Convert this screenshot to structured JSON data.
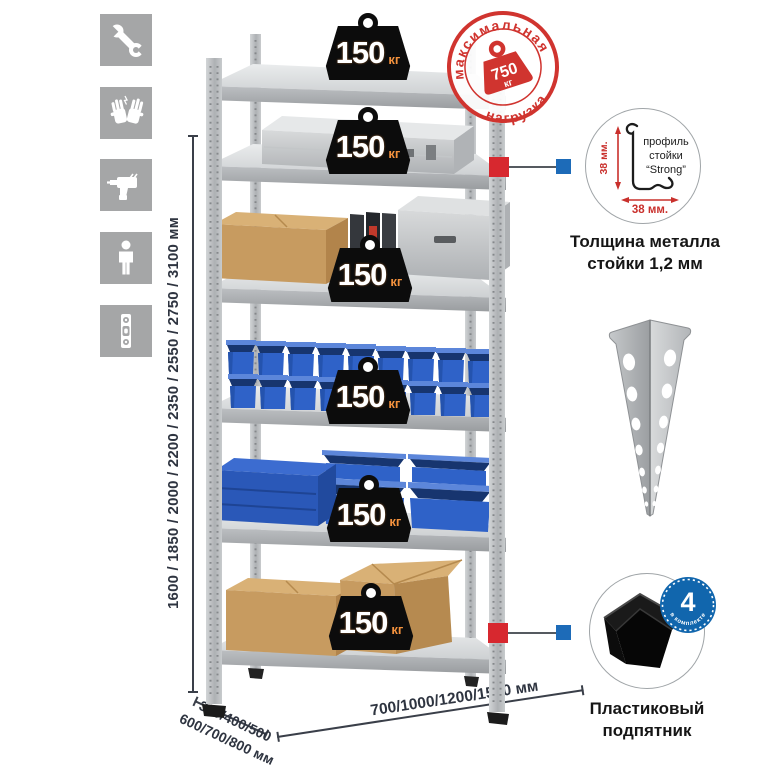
{
  "sidebar": {
    "icons": [
      "wrench",
      "gloves",
      "drill",
      "person",
      "level"
    ]
  },
  "rack": {
    "shelves_count": 6,
    "load_value": "150",
    "load_unit": "кг"
  },
  "stamp": {
    "arc_top": "максимальная",
    "arc_bottom": "нагрузка",
    "value": "750",
    "unit": "кг"
  },
  "dimensions": {
    "height": "1600 / 1850 / 2000 / 2200 / 2350 / 2550 / 2750 / 3100 мм",
    "depth_line1": "300/400/500",
    "depth_line2": "600/700/800 мм",
    "width": "700/1000/1200/1500 мм"
  },
  "profile_detail": {
    "line1": "профиль",
    "line2": "стойки",
    "line3": "“Strong”",
    "dim_vertical": "38 мм.",
    "dim_horizontal": "38 мм.",
    "caption_line1": "Толщина металла",
    "caption_line2": "стойки 1,2 мм"
  },
  "foot_detail": {
    "qty": "4",
    "qty_label": "в комплекте",
    "caption_line1": "Пластиковый",
    "caption_line2": "подпятник"
  },
  "colors": {
    "stamp_red": "#d0342f",
    "marker_red": "#d7282f",
    "marker_blue": "#1d6bb8",
    "bin_blue": "#2f62c8",
    "dimension_text": "#2e3440",
    "icon_tile_gray": "#a5a6a7"
  }
}
